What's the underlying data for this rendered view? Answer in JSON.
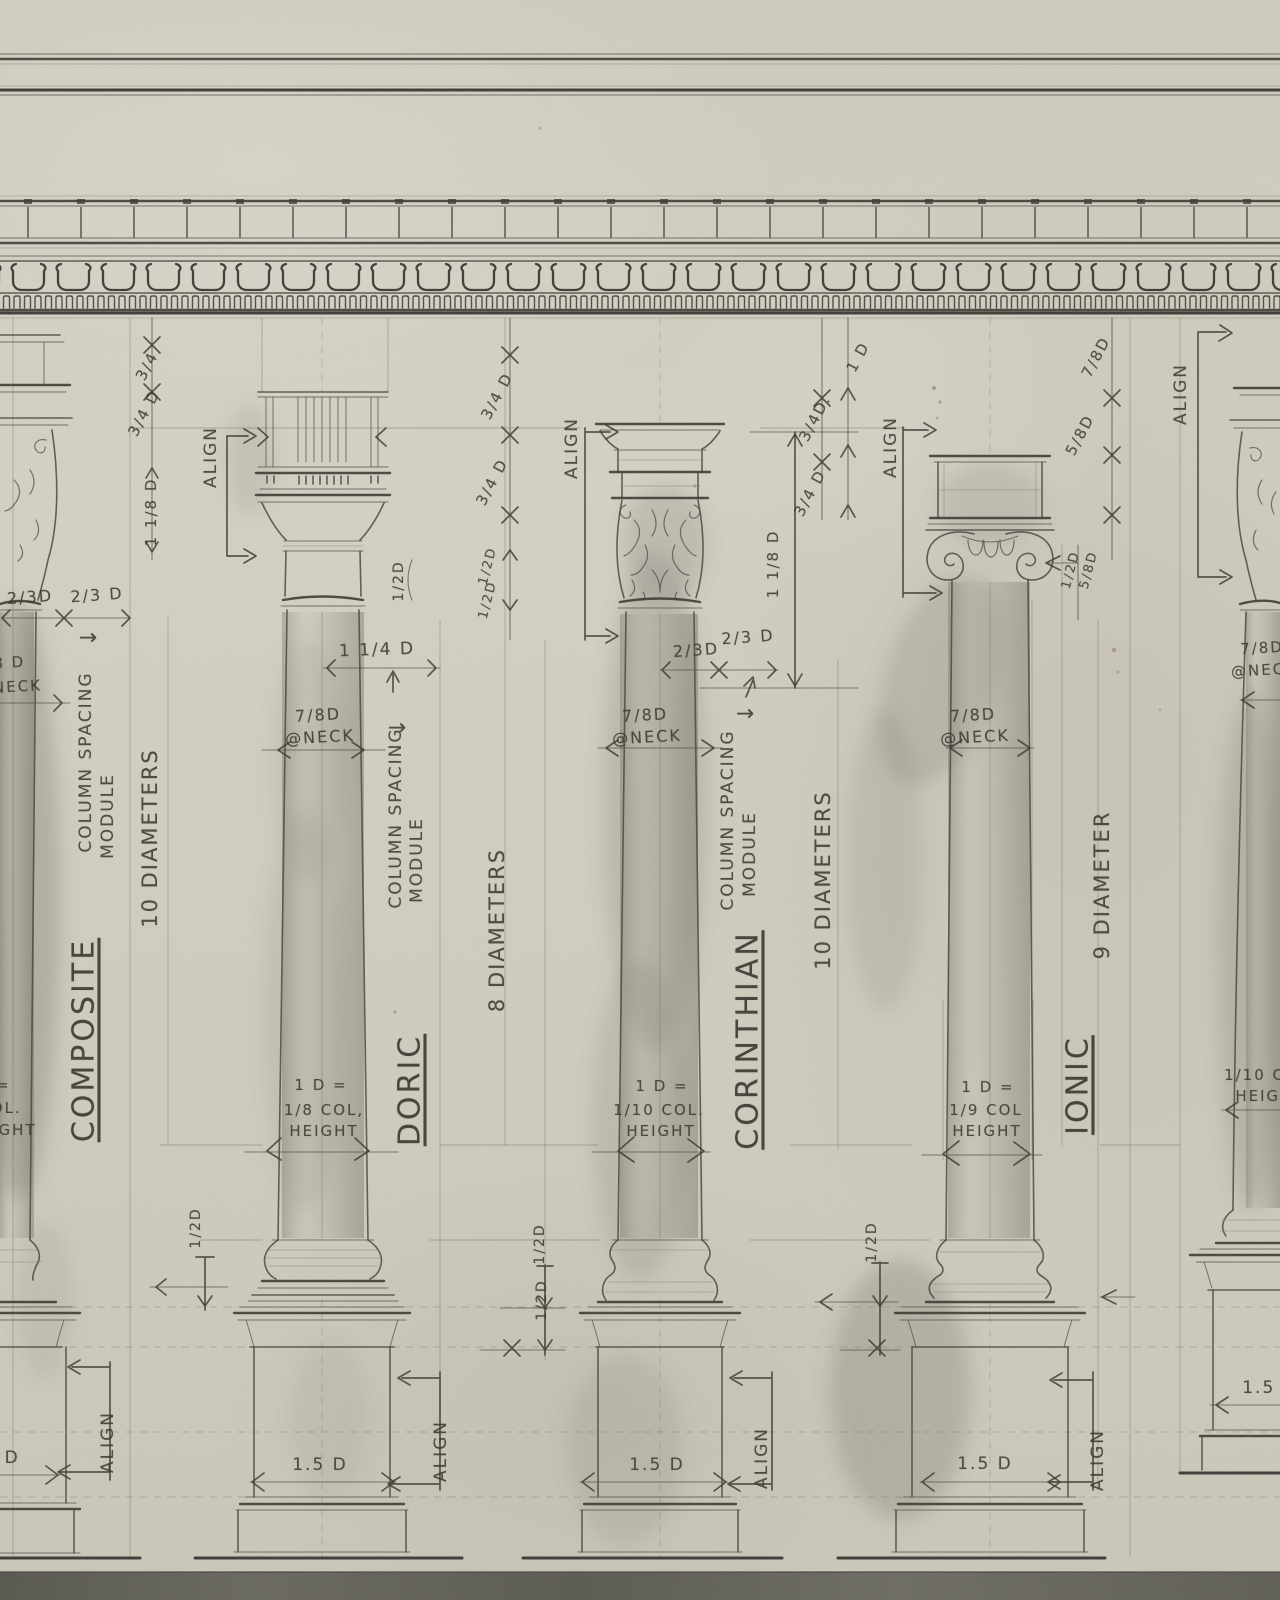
{
  "drawing": {
    "subject": "Classical column orders comparative study",
    "orders_shown": [
      "COMPOSITE",
      "DORIC",
      "CORINTHIAN",
      "IONIC"
    ]
  },
  "labels": {
    "align": "ALIGN",
    "composite": "COMPOSITE",
    "doric": "DORIC",
    "corinthian": "CORINTHIAN",
    "ionic": "IONIC",
    "column_spacing": "COLUMN SPACING",
    "module": "MODULE",
    "arrow_right": "→",
    "dia10": "10 DIAMETERS",
    "dia8": "8 DIAMETERS",
    "dia9": "9 DIAMETER",
    "neck78": "7/8D",
    "neck78sp": "7/8 D",
    "at_neck": "@NECK",
    "r_eq": "1 D =",
    "r_d8": "1/8 COL,",
    "r_d10": "1/10 COL.",
    "r_d9": "1/9 COL",
    "r_col": "COL.",
    "r_h": "HEIGHT",
    "d34": "3/4",
    "d34d": "3/4 D",
    "d34dd": "3/4D.",
    "d118": "1 1/8 D",
    "d23": "2/3 D",
    "d23t": "2/3D",
    "d12": "1/2D",
    "d114": "1 1/4 D",
    "d1": "1 D",
    "d58": "5/8D",
    "d78": "7/8D",
    "d15": "1.5 D"
  },
  "colors": {
    "paper": "#d3d0c3",
    "pencil_dark": "#2e2c27",
    "pencil_mid": "#45433c",
    "pencil_light": "#7d7a6c",
    "bottom_band": "#5e5d55",
    "rust_speck": "#8b5a3c"
  }
}
